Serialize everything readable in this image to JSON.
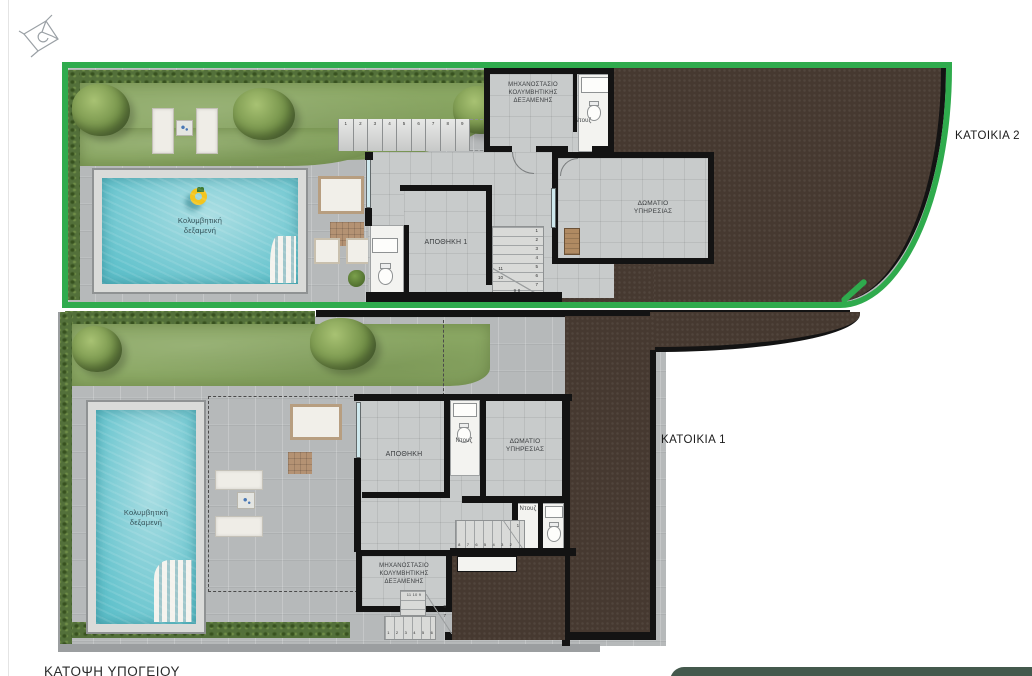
{
  "plan": {
    "caption": "ΚΑΤΟΨΗ ΥΠΟΓΕΙΟΥ",
    "colors": {
      "boundary_green": "#2fab4d",
      "earth_brown": "#463930",
      "pool_water": "#79cbd4",
      "grass_green": "#8aa763",
      "hedge_green": "#53703a",
      "concrete_gray": "#b6b9ba",
      "wall_black": "#131313",
      "banner_green": "#44594d"
    }
  },
  "residence2": {
    "label": "ΚΑΤΟΙΚΙΑ 2",
    "rooms": {
      "machinery": {
        "lines": [
          "ΜΗΧΑΝΟΣΤΑΣΙΟ",
          "ΚΟΛΥΜΒΗΤΙΚΗΣ",
          "ΔΕΞΑΜΕΝΗΣ"
        ]
      },
      "shower": "Ντουζ",
      "service": {
        "lines": [
          "ΔΩΜΑΤΙΟ",
          "ΥΠΗΡΕΣΙΑΣ"
        ]
      },
      "storage": "ΑΠΟΘΗΚΗ 1",
      "pool": {
        "lines": [
          "Κολυμβητική",
          "δεξαμενή"
        ]
      }
    },
    "stairs": {
      "terrace": [
        "1",
        "2",
        "3",
        "4",
        "5",
        "6",
        "7",
        "8",
        "9"
      ],
      "interior_right": [
        "1",
        "2",
        "3",
        "4",
        "5",
        "6",
        "7"
      ],
      "interior_left": [
        "11",
        "10"
      ],
      "interior_bottom": "9 8"
    }
  },
  "residence1": {
    "label": "ΚΑΤΟΙΚΙΑ 1",
    "rooms": {
      "storage": "ΑΠΟΘΗΚΗ",
      "shower1": "Ντουζ",
      "shower2": "Ντουζ",
      "service": {
        "lines": [
          "ΔΩΜΑΤΙΟ",
          "ΥΠΗΡΕΣΙΑΣ"
        ]
      },
      "machinery": {
        "lines": [
          "ΜΗΧΑΝΟΣΤΑΣΙΟ",
          "ΚΟΛΥΜΒΗΤΙΚΗΣ",
          "ΔΕΞΑΜΕΝΗΣ"
        ]
      },
      "pool": {
        "lines": [
          "Κολυμβητική",
          "δεξαμενή"
        ]
      }
    },
    "stairs": {
      "interior": [
        "8",
        "7",
        "6",
        "5",
        "4",
        "3",
        "2"
      ],
      "interior_top": "1",
      "exterior_lower": [
        "1",
        "2",
        "3",
        "4",
        "5",
        "6"
      ],
      "exterior_upper": "11 10 9",
      "exterior_side": [
        "8",
        "7"
      ]
    }
  }
}
